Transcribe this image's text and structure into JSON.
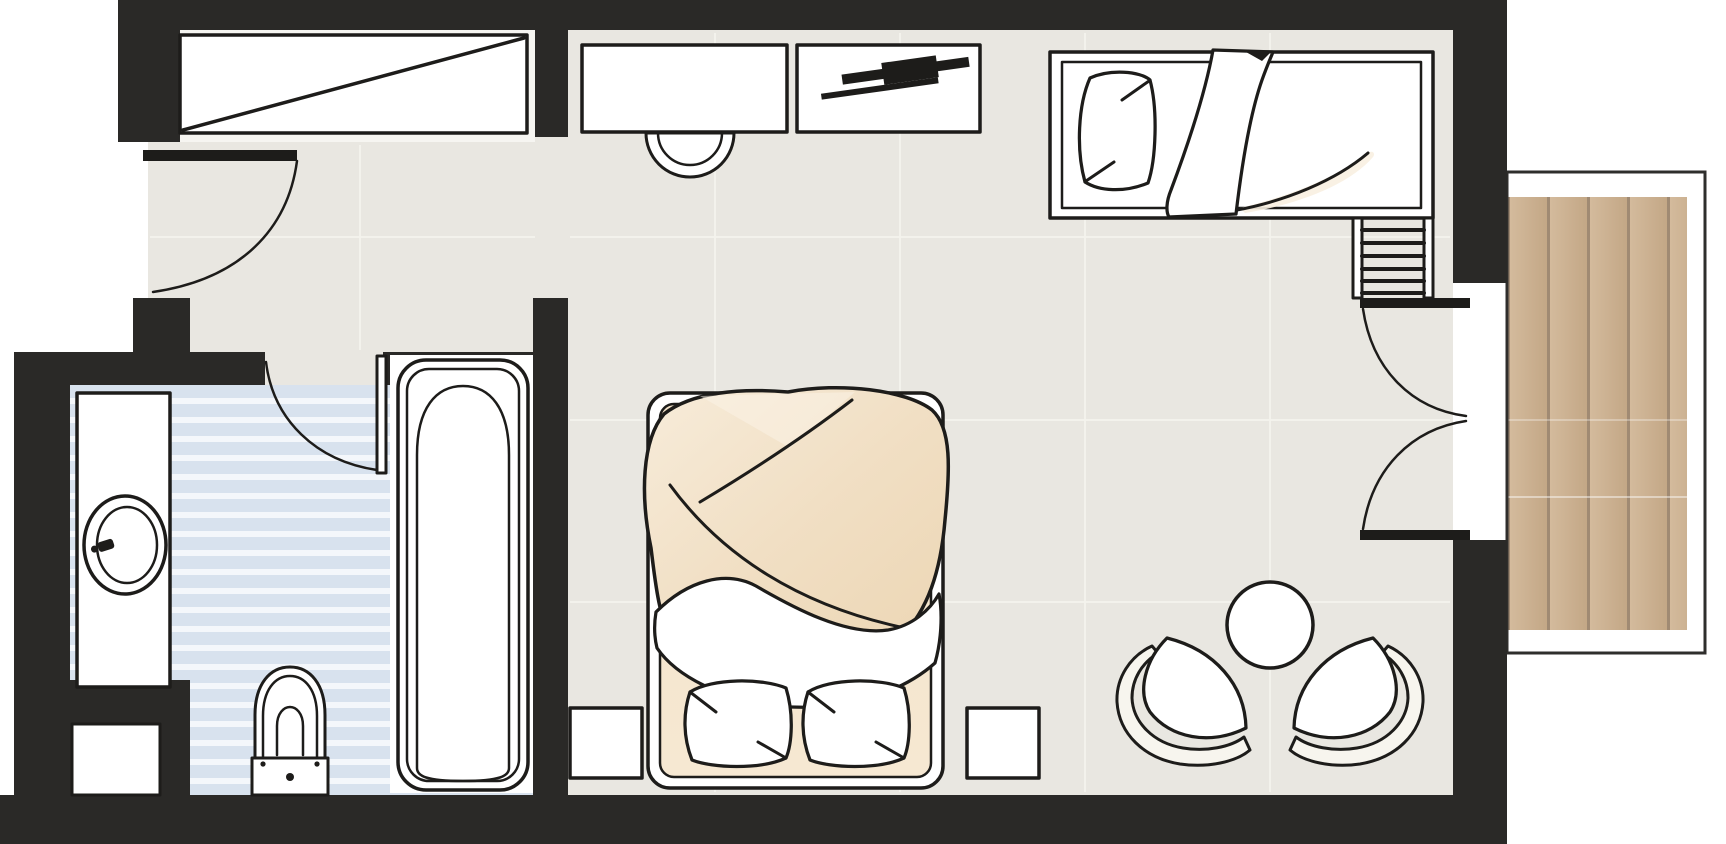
{
  "meta": {
    "title": "Hotel guest room floor plan with bathroom, bedroom and wooden balcony"
  },
  "colors": {
    "wall": "#2a2927",
    "line": "#1d1c1a",
    "floor": "#e9e7e1",
    "floor_seam": "#f5f4ee",
    "niche_floor": "#f6f5f1",
    "bath_blue": "#d8e2ee",
    "bath_stripe": "#f4f7fb",
    "bedding_light": "#f8efe1",
    "bedding": "#f1dfc6",
    "bedding_deep": "#e9d2b1",
    "deck": "#cbb094",
    "deck_dark": "#a08a73",
    "deck_light": "#d9c3a6",
    "balcony_line": "#2f2e2c",
    "white": "#ffffff"
  },
  "rooms": [
    {
      "id": "entry",
      "label": "Entry corridor"
    },
    {
      "id": "bathroom",
      "label": "Bathroom"
    },
    {
      "id": "bedroom",
      "label": "Bedroom / living area"
    },
    {
      "id": "balcony",
      "label": "Balcony with wood deck"
    }
  ],
  "fixtures": [
    {
      "id": "wardrobe",
      "label": "Built-in wardrobe"
    },
    {
      "id": "entrance-door",
      "label": "Entrance door"
    },
    {
      "id": "desk",
      "label": "Desk"
    },
    {
      "id": "desk-chair",
      "label": "Desk chair"
    },
    {
      "id": "tv-console",
      "label": "TV console"
    },
    {
      "id": "tv",
      "label": "Flat-screen TV"
    },
    {
      "id": "single-bed",
      "label": "Single day bed"
    },
    {
      "id": "luggage-rack",
      "label": "Luggage rack"
    },
    {
      "id": "balcony-doors",
      "label": "Double balcony doors"
    },
    {
      "id": "double-bed",
      "label": "Double bed"
    },
    {
      "id": "nightstand-left",
      "label": "Nightstand (left)"
    },
    {
      "id": "nightstand-right",
      "label": "Nightstand (right)"
    },
    {
      "id": "coffee-table",
      "label": "Round table"
    },
    {
      "id": "armchair-left",
      "label": "Armchair (left)"
    },
    {
      "id": "armchair-right",
      "label": "Armchair (right)"
    },
    {
      "id": "vanity",
      "label": "Vanity with washbasin"
    },
    {
      "id": "toilet",
      "label": "Toilet"
    },
    {
      "id": "bathtub",
      "label": "Bathtub"
    },
    {
      "id": "bathroom-door",
      "label": "Bathroom door"
    },
    {
      "id": "service-niche",
      "label": "Service niche"
    }
  ]
}
